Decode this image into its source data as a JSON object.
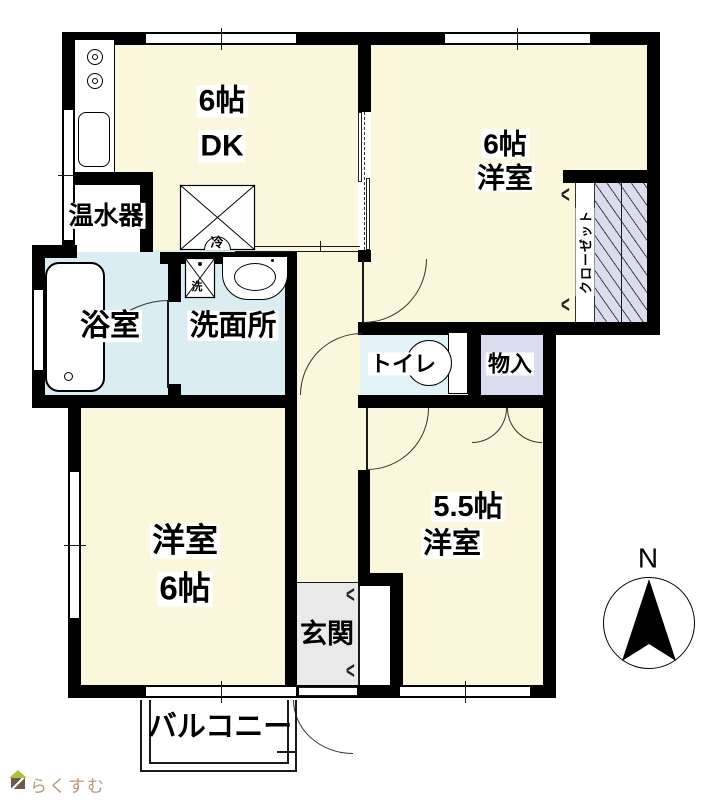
{
  "floorplan": {
    "rooms": {
      "dk": {
        "size_label": "6帖",
        "name_label": "DK"
      },
      "western_room_ne": {
        "size_label": "6帖",
        "name_label": "洋室"
      },
      "bathroom": {
        "name_label": "浴室"
      },
      "washroom": {
        "name_label": "洗面所"
      },
      "water_heater": {
        "name_label": "温水器"
      },
      "toilet": {
        "name_label": "トイレ"
      },
      "storage": {
        "name_label": "物入"
      },
      "western_room_sw": {
        "name_label": "洋室",
        "size_label": "6帖"
      },
      "western_room_se": {
        "size_label": "5.5帖",
        "name_label": "洋室"
      },
      "entrance": {
        "name_label": "玄関"
      },
      "balcony": {
        "name_label": "バルコニー"
      },
      "closet": {
        "name_label": "クローゼット"
      }
    },
    "fixtures": {
      "refrigerator_label": "冷",
      "washer_label": "洗"
    },
    "compass": {
      "north_label": "N"
    },
    "icons": {
      "bifold_door_symbol": "<"
    },
    "watermark": {
      "text": "らくすむ"
    },
    "colors": {
      "room_cream": "#FBF7DC",
      "wet_area_blue": "#D9EDF2",
      "toilet_blue": "#E2F3F8",
      "closet_lavender": "#DCDCF0",
      "entrance_gray": "#E9E9E9",
      "wall_black": "#000000",
      "logo_text": "#B39A7B",
      "logo_roof_green": "#A9C23F",
      "logo_body_brown": "#6B5B4E"
    }
  }
}
